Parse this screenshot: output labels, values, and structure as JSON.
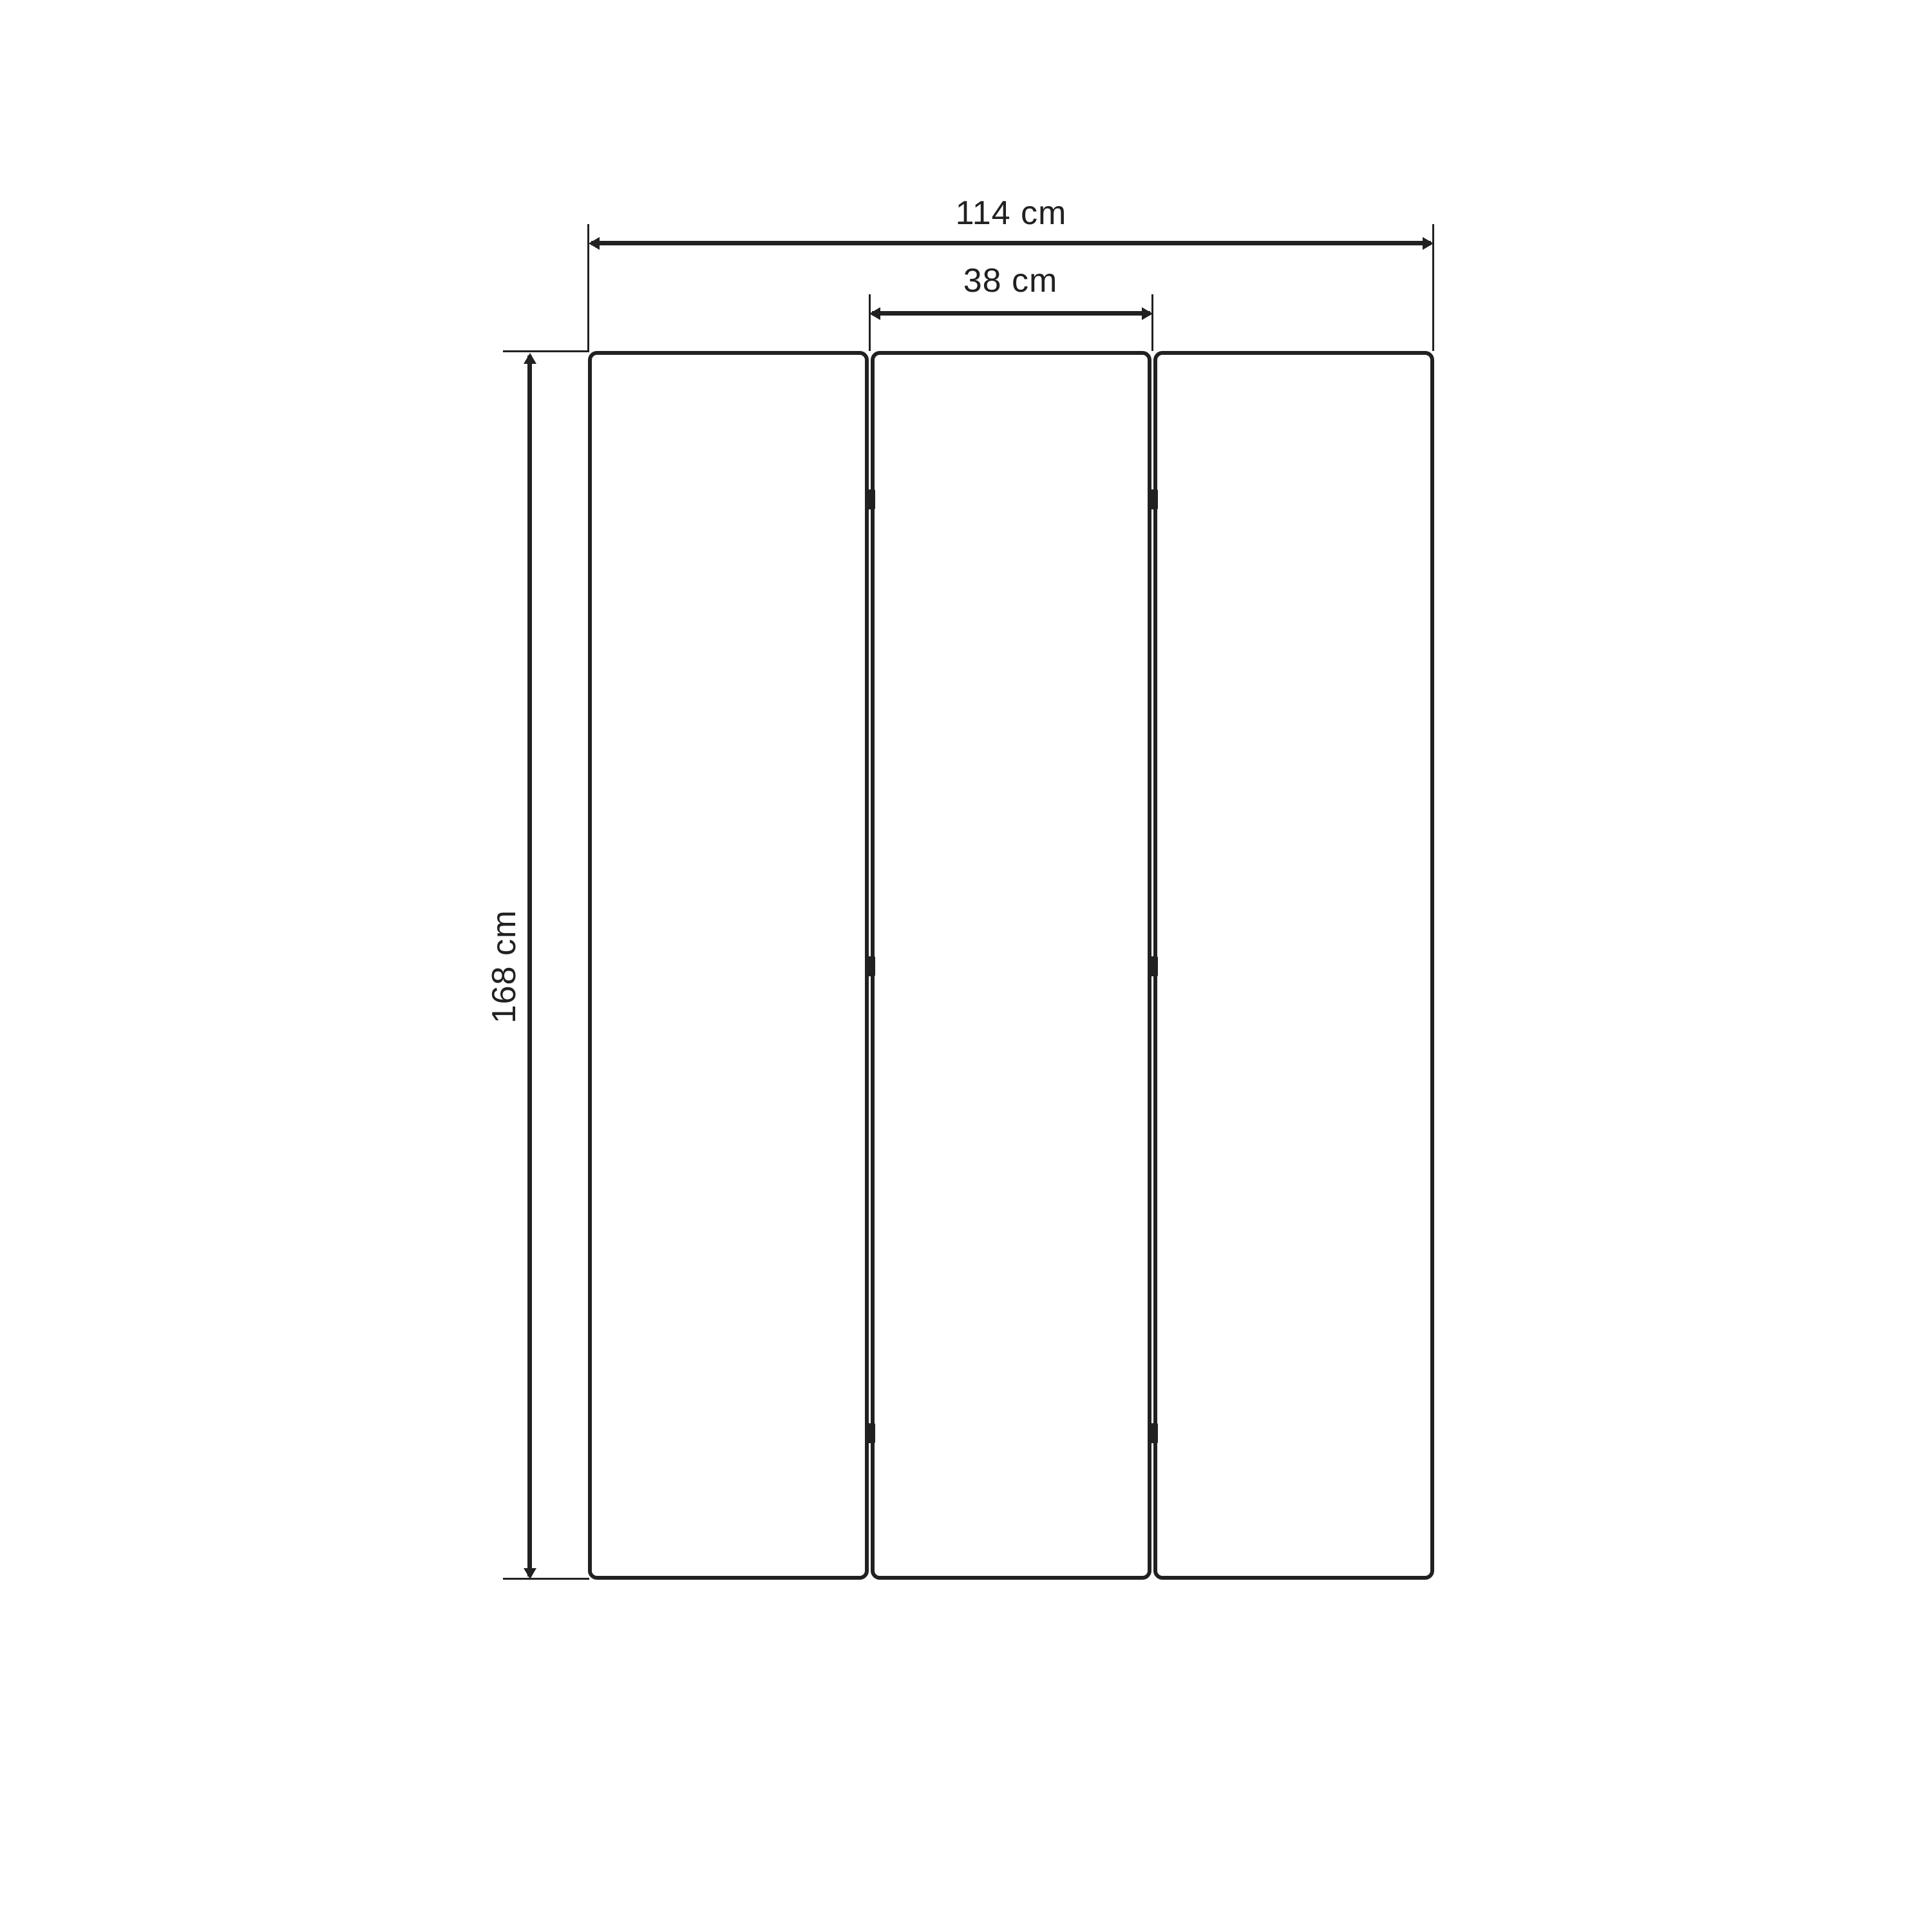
{
  "diagram": {
    "kind": "furniture-dimension-drawing",
    "subject": "three-panel folding screen, front view",
    "panels": {
      "count": 3,
      "hinge_rows": 3
    },
    "dimensions": {
      "overall_width": {
        "label": "114 cm",
        "value": 114,
        "unit": "cm"
      },
      "panel_width": {
        "label": "38 cm",
        "value": 38,
        "unit": "cm"
      },
      "height": {
        "label": "168 cm",
        "value": 168,
        "unit": "cm"
      }
    },
    "colors": {
      "line": "#212121",
      "background": "#ffffff"
    }
  }
}
